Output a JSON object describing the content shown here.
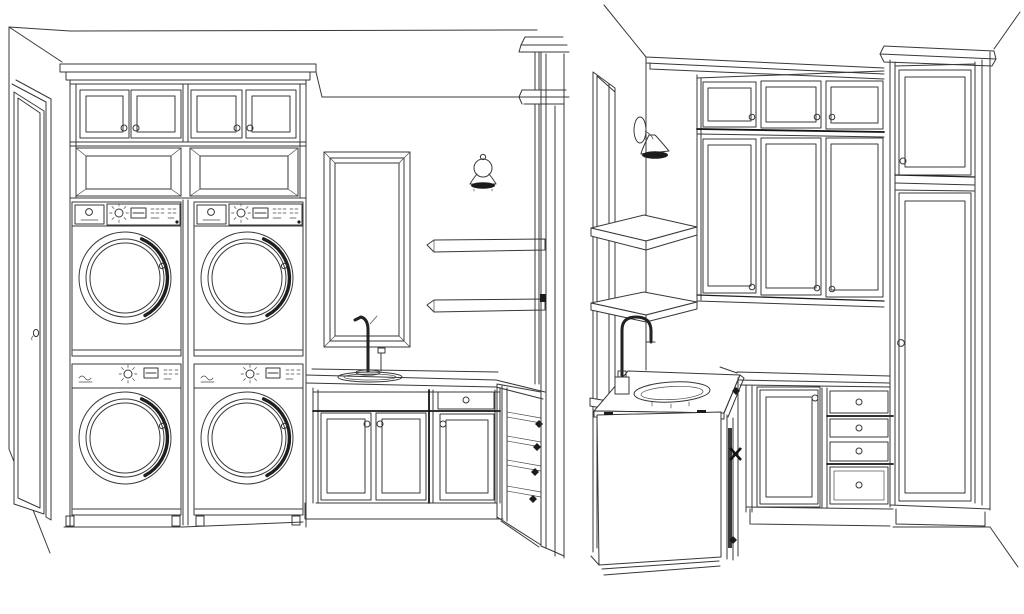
{
  "canvas": {
    "width": 1024,
    "height": 614,
    "background": "#ffffff",
    "line_color": "#383838",
    "accent_dark": "#1b1b1b"
  },
  "views": {
    "elevation": {
      "label": "laundry room front elevation drawing",
      "objects": {
        "door": "open entry door with knob",
        "upper_cabinets": "two pairs of cabinet doors with knobs",
        "cubbies": "two open shelf niches",
        "laundry": "two stacked washer and dryer units with round doors",
        "mirror": "tall framed mirror",
        "sconce": "wall sconce light",
        "shelves": "two floating wall shelves",
        "sink": "drop-in sink with tall faucet and soap pump",
        "base_cabinets": "double-door cabinet, drawer over door cabinet",
        "corner_cabinet": "angled corner cabinet with dark knobs",
        "tall_cabinet": "tall cabinet seen in side profile with crown molding"
      }
    },
    "perspective": {
      "label": "laundry room corner perspective drawing",
      "objects": {
        "window": "tall window on left wall",
        "sconce": "wall sconce light",
        "shelves": "two floating corner shelves",
        "upper_cabinets": "upper cabinet run, small doors over tall doors, knobs",
        "pantry": "tall pantry cabinet with upper door and tall door",
        "sink_cabinet": "freestanding sink cabinet with oval sink",
        "faucet": "dark gooseneck faucet",
        "base_cabinets": "shaker door cabinet and four-drawer stack with knobs"
      }
    }
  }
}
